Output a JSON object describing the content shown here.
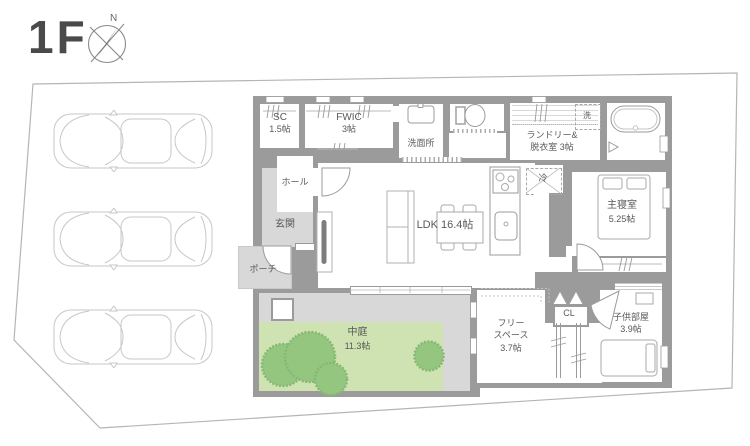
{
  "header": {
    "floor": "1F",
    "compass_north": "N"
  },
  "rooms": {
    "shoe_closet": {
      "name": "SC",
      "size": "1.5帖"
    },
    "fwic": {
      "name": "FWIC",
      "size": "3帖"
    },
    "washroom": {
      "name": "洗面所"
    },
    "laundry": {
      "name": "ランドリー&",
      "name2": "脱衣室 3帖"
    },
    "washer": {
      "label": "洗"
    },
    "hall": {
      "name": "ホール"
    },
    "entrance": {
      "name": "玄関"
    },
    "porch": {
      "name": "ポーチ"
    },
    "ldk": {
      "name": "LDK 16.4帖"
    },
    "fridge": {
      "label": "冷"
    },
    "master_bedroom": {
      "name": "主寝室",
      "size": "5.25帖"
    },
    "courtyard": {
      "name": "中庭",
      "size": "11.3帖"
    },
    "free_space": {
      "name": "フリー",
      "name2": "スペース",
      "size": "3.7帖"
    },
    "closet": {
      "label": "CL"
    },
    "kids_room": {
      "name": "子供部屋",
      "size": "3.9帖"
    }
  },
  "colors": {
    "wall": "#9b9b9b",
    "floor_gray": "#d8d8d8",
    "courtyard_green": "#cfe2b2",
    "tree_green": "#94c67f",
    "text": "#595959"
  }
}
